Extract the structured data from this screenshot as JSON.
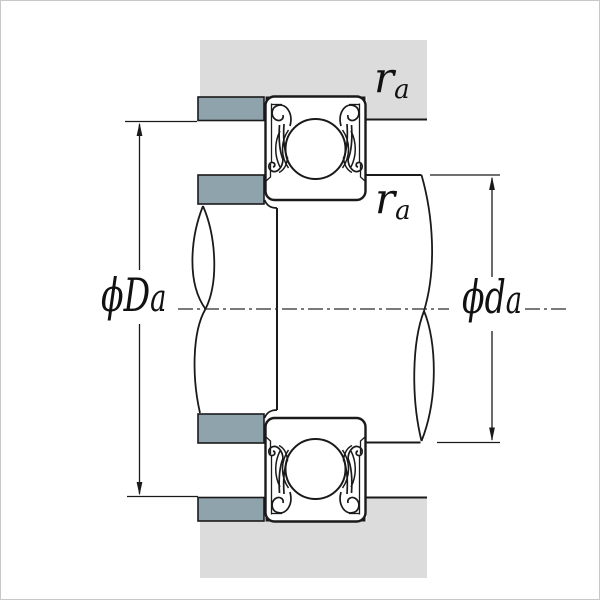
{
  "diagram": {
    "type": "bearing-shaft-housing-mounting-cross-section",
    "labels": {
      "housing_shoulder_diameter": {
        "symbol": "ϕD",
        "subscript": "a"
      },
      "shaft_shoulder_diameter": {
        "symbol": "ϕd",
        "subscript": "a"
      },
      "fillet_radius_housing": {
        "symbol": "r",
        "subscript": "a"
      },
      "fillet_radius_shaft": {
        "symbol": "r",
        "subscript": "a"
      }
    },
    "colors": {
      "housing_fill": "#dcdcdc",
      "shoulder_fill": "#8fa3ad",
      "line": "#1a1a1a",
      "background": "#ffffff",
      "border": "#c8c8c8"
    }
  }
}
